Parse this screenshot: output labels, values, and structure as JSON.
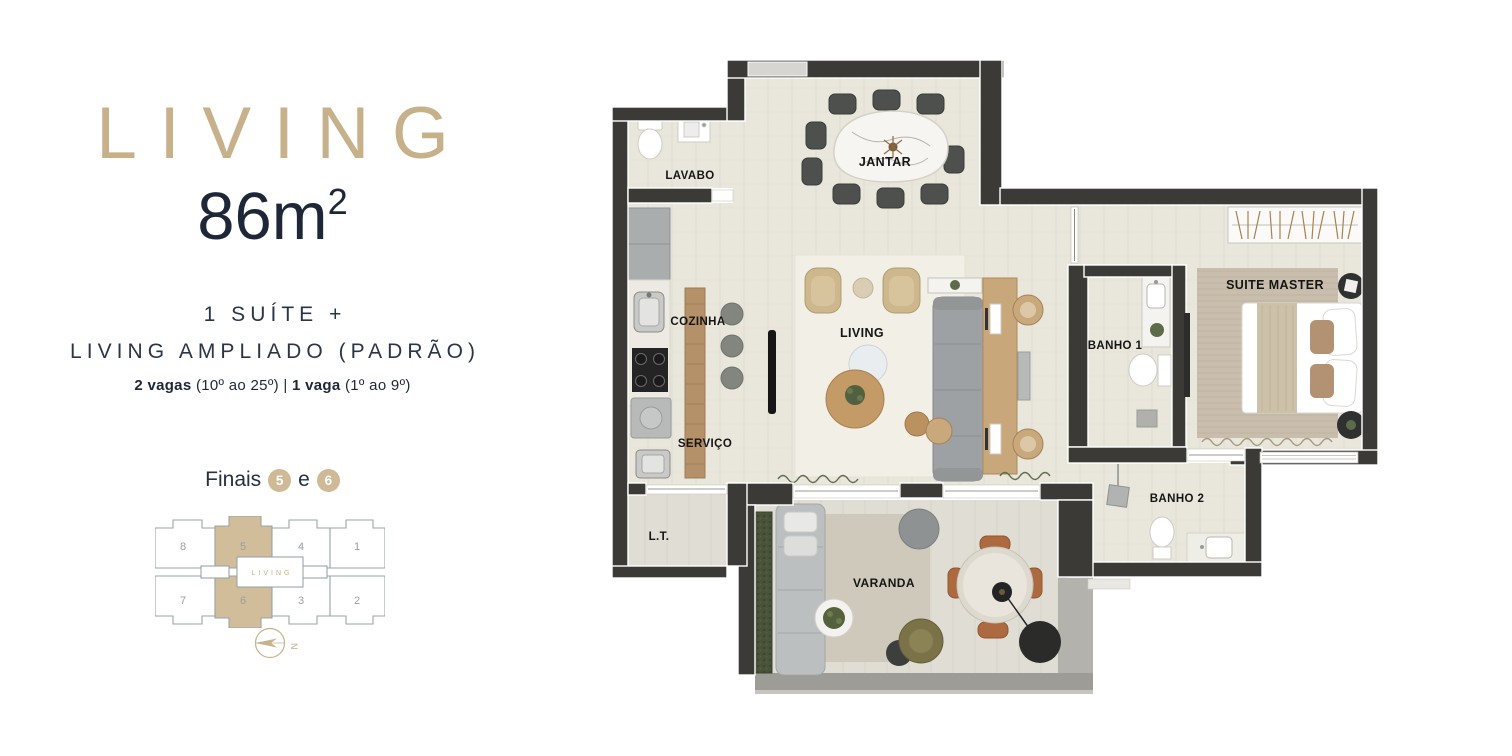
{
  "colors": {
    "accent_tan": "#c7b18a",
    "badge_tan": "#cfb996",
    "navy": "#1d2737",
    "wall": "#3b3a36",
    "floor": "#e9e6db",
    "keyplan_highlight": "#d2bd9b"
  },
  "left_panel": {
    "title": "LIVING",
    "area_value": "86m",
    "area_sup": "2",
    "subtitle_line1": "1 SUÍTE +",
    "subtitle_line2": "LIVING AMPLIADO (PADRÃO)",
    "parking": {
      "bold1": "2 vagas",
      "text1": " (10º ao 25º) | ",
      "bold2": "1 vaga",
      "text2": " (1º ao 9º)"
    },
    "finais": {
      "label": "Finais",
      "connector": "e",
      "units": [
        "5",
        "6"
      ]
    },
    "keyplan": {
      "living_label": "LIVING",
      "units_top": [
        "8",
        "5",
        "4",
        "1"
      ],
      "units_bottom": [
        "7",
        "6",
        "3",
        "2"
      ]
    },
    "compass_letter": "N"
  },
  "floor_plan": {
    "rooms": {
      "lavabo": "LAVABO",
      "jantar": "JANTAR",
      "cozinha": "COZINHA",
      "living": "LIVING",
      "servico": "SERVIÇO",
      "lt": "L.T.",
      "varanda": "VARANDA",
      "banho1": "BANHO 1",
      "suite": "SUITE MASTER",
      "banho2": "BANHO 2"
    }
  }
}
